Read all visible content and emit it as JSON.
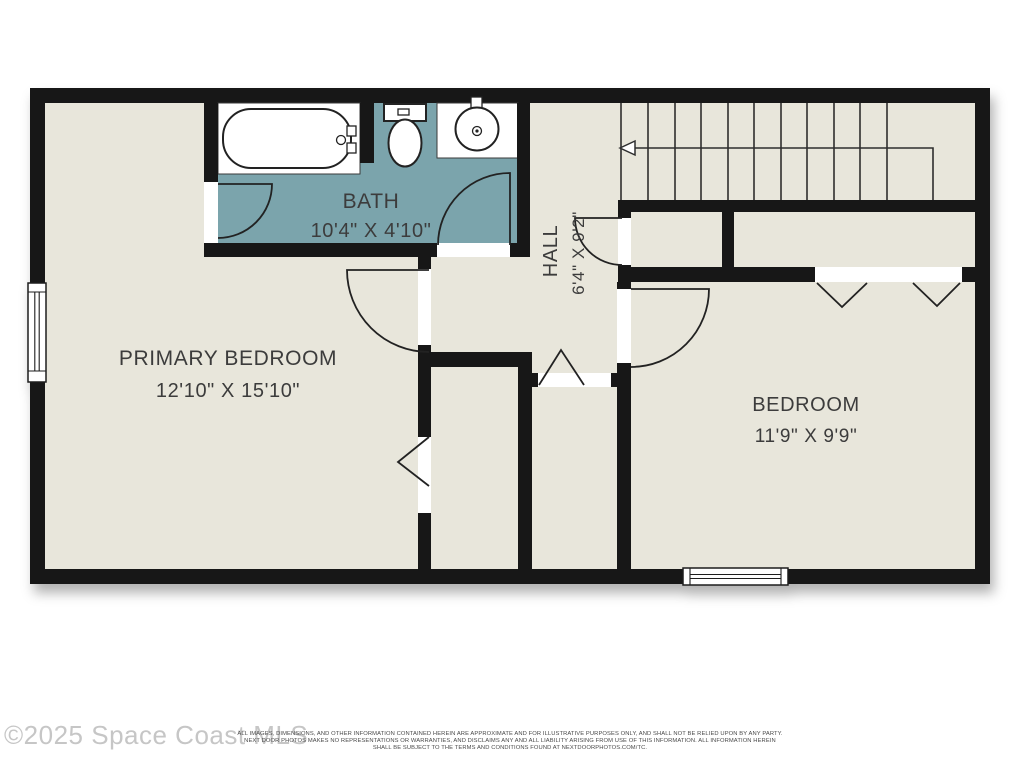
{
  "watermark": "©2025 Space Coast MLS",
  "disclaimer": {
    "line1": "ALL IMAGES, DIMENSIONS, AND OTHER INFORMATION CONTAINED HEREIN ARE APPROXIMATE AND FOR ILLUSTRATIVE PURPOSES ONLY, AND SHALL NOT BE RELIED UPON BY ANY PARTY.",
    "line2": "NEXT DOOR PHOTOS MAKES NO REPRESENTATIONS OR WARRANTIES, AND DISCLAIMS ANY AND ALL LIABILITY ARISING FROM USE OF THIS INFORMATION. ALL INFORMATION HEREIN",
    "line3": "SHALL BE SUBJECT TO THE TERMS AND CONDITIONS FOUND AT NEXTDOORPHOTOS.COM/TC."
  },
  "rooms": {
    "primary_bedroom": {
      "name": "PRIMARY BEDROOM",
      "dimensions": "12'10\" X 15'10\""
    },
    "bath": {
      "name": "BATH",
      "dimensions": "10'4\" X 4'10\""
    },
    "hall": {
      "name": "HALL",
      "dimensions": "6'4\" X 9'2\""
    },
    "bedroom": {
      "name": "BEDROOM",
      "dimensions": "11'9\" X 9'9\""
    }
  },
  "fixtures": [
    "bathtub",
    "toilet",
    "sink",
    "staircase",
    "windows",
    "doors",
    "closets"
  ],
  "colors": {
    "wall": "#171717",
    "floor": "#E8E6DB",
    "bath_floor": "#7BA4AC",
    "line": "#222222",
    "label": "#3C3C3C",
    "watermark": "#C6C6C6",
    "background": "#FFFFFF"
  }
}
